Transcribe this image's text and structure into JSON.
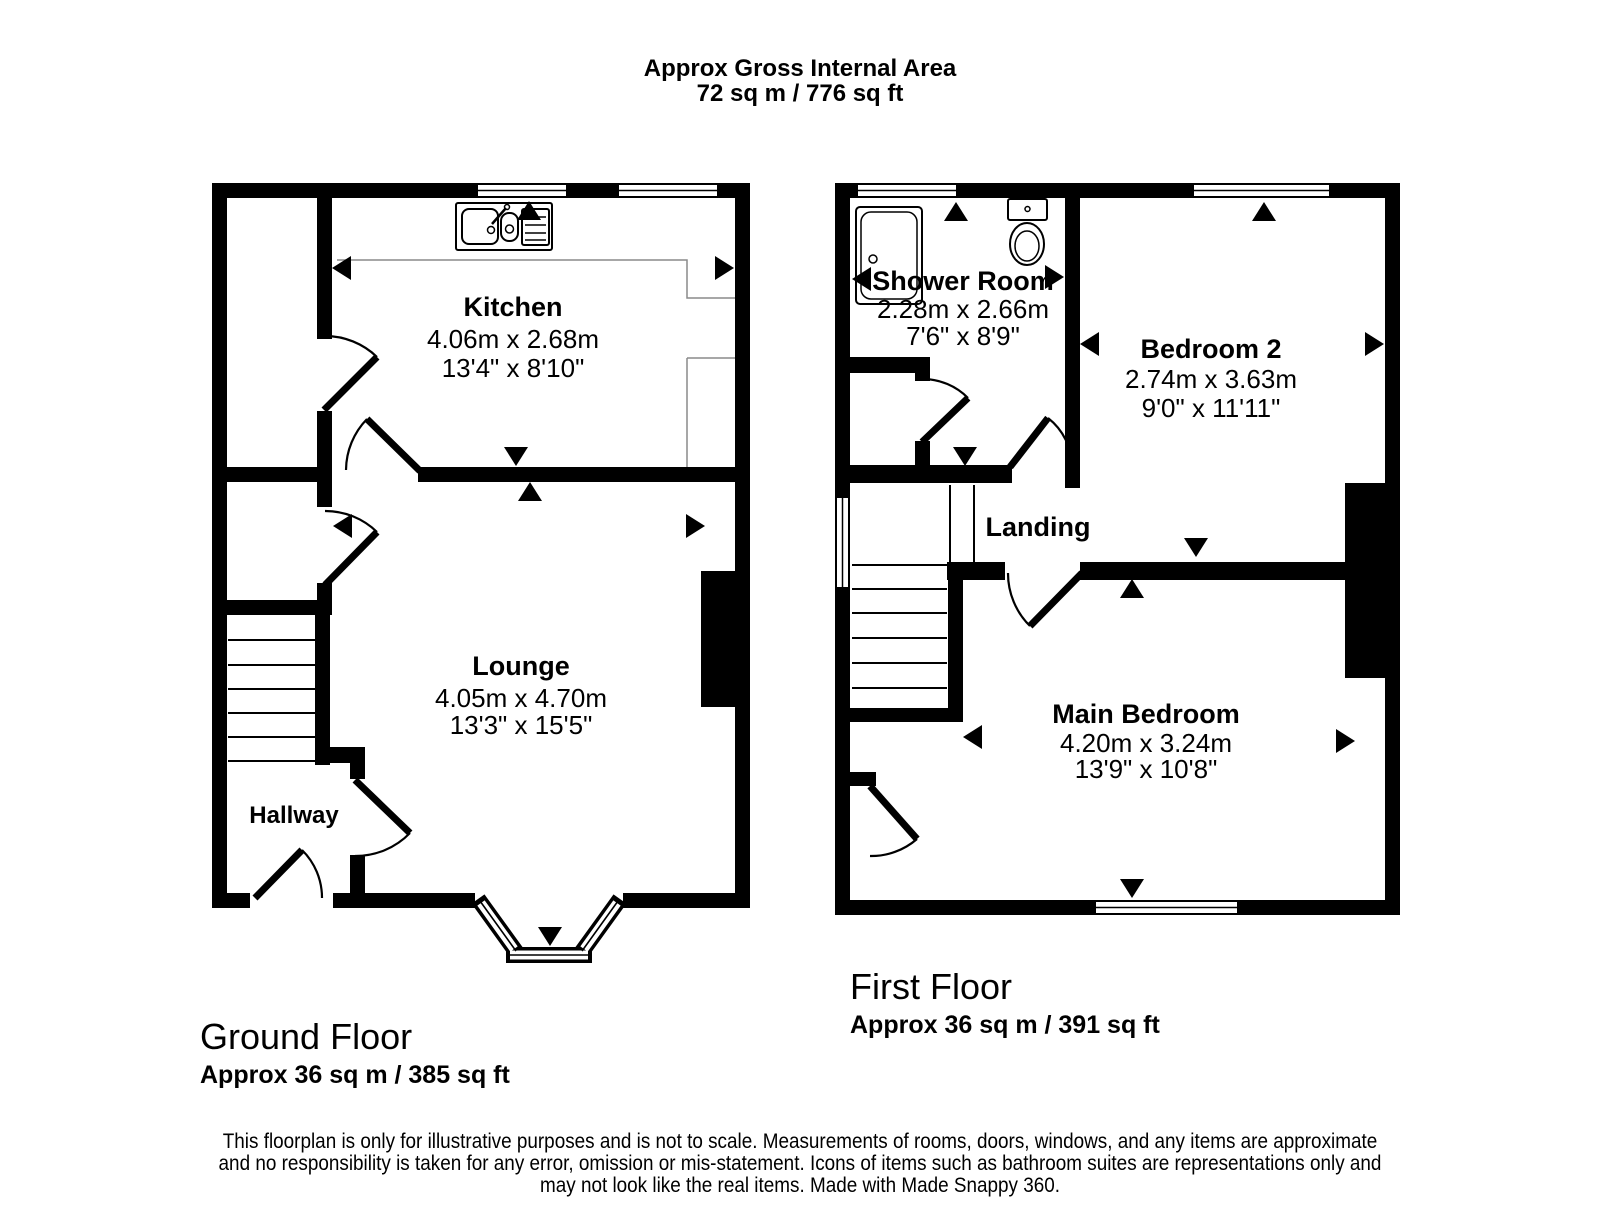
{
  "header": {
    "title": "Approx Gross Internal Area",
    "area": "72 sq m / 776 sq ft"
  },
  "ground_floor": {
    "caption": "Ground Floor",
    "caption_area": "Approx 36 sq m / 385 sq ft",
    "rooms": {
      "kitchen": {
        "name": "Kitchen",
        "metric": "4.06m x 2.68m",
        "imperial": "13'4\" x 8'10\""
      },
      "lounge": {
        "name": "Lounge",
        "metric": "4.05m x 4.70m",
        "imperial": "13'3\" x 15'5\""
      },
      "hallway": {
        "name": "Hallway"
      }
    }
  },
  "first_floor": {
    "caption": "First Floor",
    "caption_area": "Approx 36 sq m / 391 sq ft",
    "rooms": {
      "shower_room": {
        "name": "Shower Room",
        "metric": "2.28m x 2.66m",
        "imperial": "7'6\" x 8'9\""
      },
      "bedroom_2": {
        "name": "Bedroom 2",
        "metric": "2.74m x 3.63m",
        "imperial": "9'0\" x 11'11\""
      },
      "landing": {
        "name": "Landing"
      },
      "main_bedroom": {
        "name": "Main Bedroom",
        "metric": "4.20m x 3.24m",
        "imperial": "13'9\" x 10'8\""
      }
    }
  },
  "icons": {
    "fixtures": [
      "kitchen-sink-icon",
      "shower-tray-icon",
      "toilet-icon"
    ],
    "markers": "direction-arrow-icon",
    "wall_color": "#000000",
    "counter_color": "#8a8a8a"
  },
  "disclaimer": {
    "line1": "This floorplan is only for illustrative purposes and is not to scale. Measurements of rooms, doors, windows, and any items are approximate",
    "line2": "and no responsibility is taken for any error, omission or mis-statement. Icons of items such as bathroom suites are representations only and",
    "line3": "may not look like the real items. Made with Made Snappy 360."
  }
}
